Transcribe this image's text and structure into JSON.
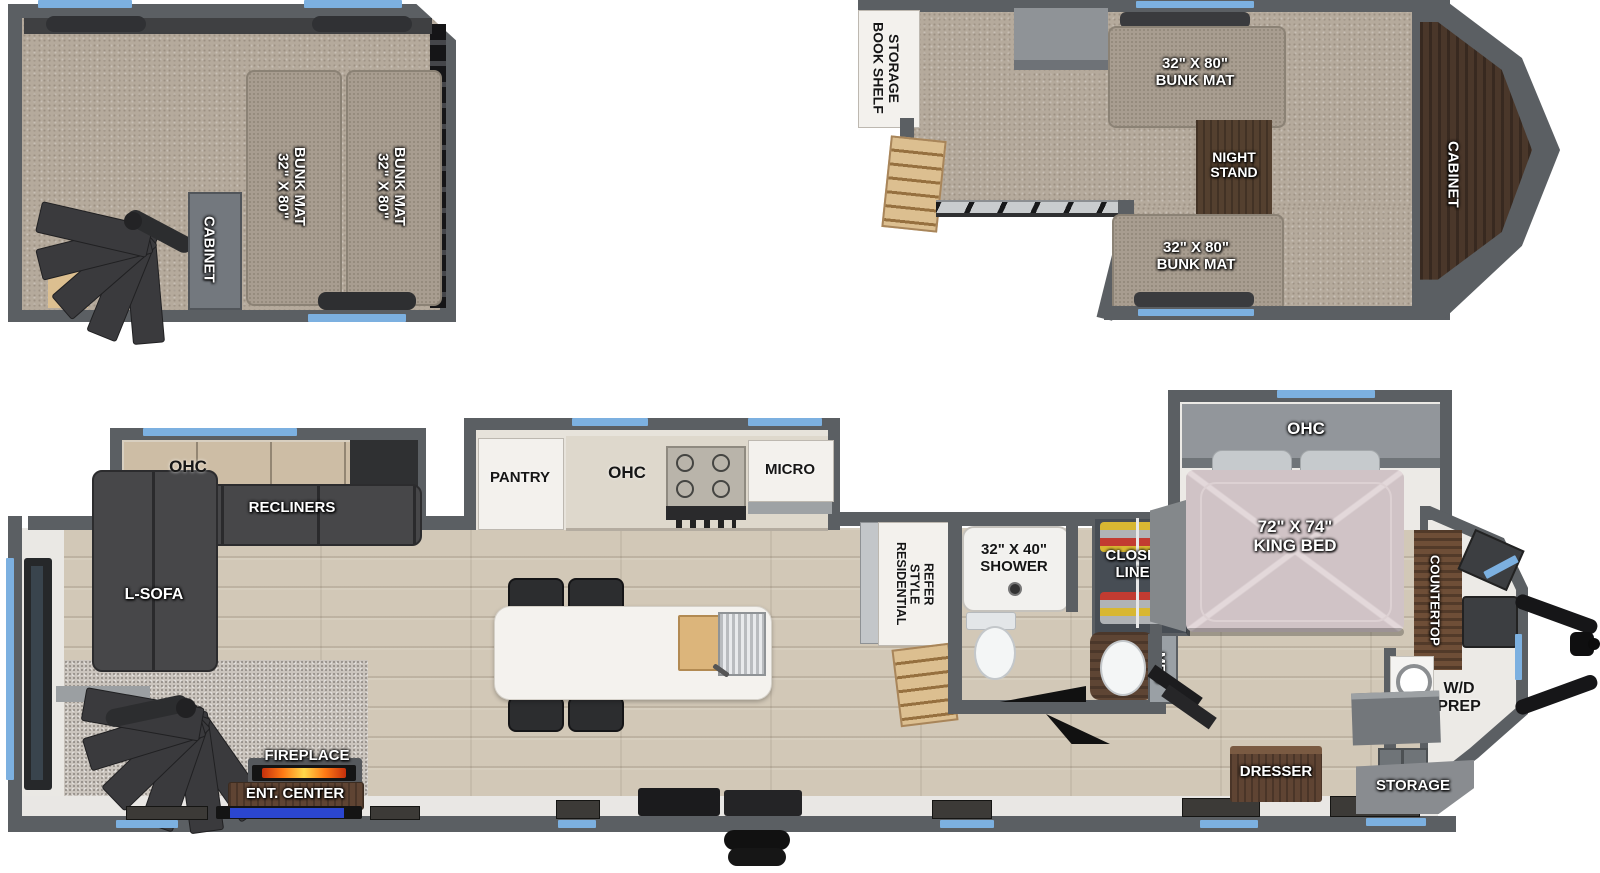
{
  "colors": {
    "wall_gray": "#5b5f63",
    "window_blue": "#7cb0e0",
    "carpet": "#b5aa9c",
    "wood_floor": "#d2c8b7",
    "furniture_dark": "#46474a",
    "wood_brown": "#5f4433",
    "accent_blue_strip": "#2b46cf",
    "flame_orange": "#ff7a15"
  },
  "rear_loft": {
    "cabinet_label": "CABINET",
    "bunk_left": {
      "l1": "32\" X 80\"",
      "l2": "BUNK MAT"
    },
    "bunk_right": {
      "l1": "32\" X 80\"",
      "l2": "BUNK MAT"
    }
  },
  "front_loft": {
    "bookshelf": {
      "l1": "BOOK SHELF",
      "l2": "STORAGE"
    },
    "bunk_top": {
      "l1": "32\" X 80\"",
      "l2": "BUNK MAT"
    },
    "night_stand": {
      "l1": "NIGHT",
      "l2": "STAND"
    },
    "cabinet_label": "CABINET",
    "bunk_bottom": {
      "l1": "32\" X 80\"",
      "l2": "BUNK MAT"
    }
  },
  "main_floor": {
    "living": {
      "ohc": "OHC",
      "recliners": "RECLINERS",
      "l_sofa": "L-SOFA",
      "fireplace": "FIREPLACE",
      "ent_center": "ENT. CENTER"
    },
    "kitchen": {
      "pantry": "PANTRY",
      "ohc": "OHC",
      "micro": "MICRO"
    },
    "refer": {
      "l1": "RESIDENTIAL",
      "l2": "STYLE",
      "l3": "REFER"
    },
    "bath": {
      "shower": {
        "l1": "32\" X 40\"",
        "l2": "SHOWER"
      },
      "closet": {
        "l1": "CLOSET/",
        "l2": "LINEN"
      },
      "med": "MED"
    },
    "bedroom": {
      "ohc": "OHC",
      "king_bed": {
        "l1": "72\" X 74\"",
        "l2": "KING BED"
      }
    },
    "front": {
      "countertop": "COUNTERTOP",
      "wd_prep": {
        "l1": "W/D",
        "l2": "PREP"
      },
      "storage": "STORAGE",
      "dresser": "DRESSER"
    }
  }
}
